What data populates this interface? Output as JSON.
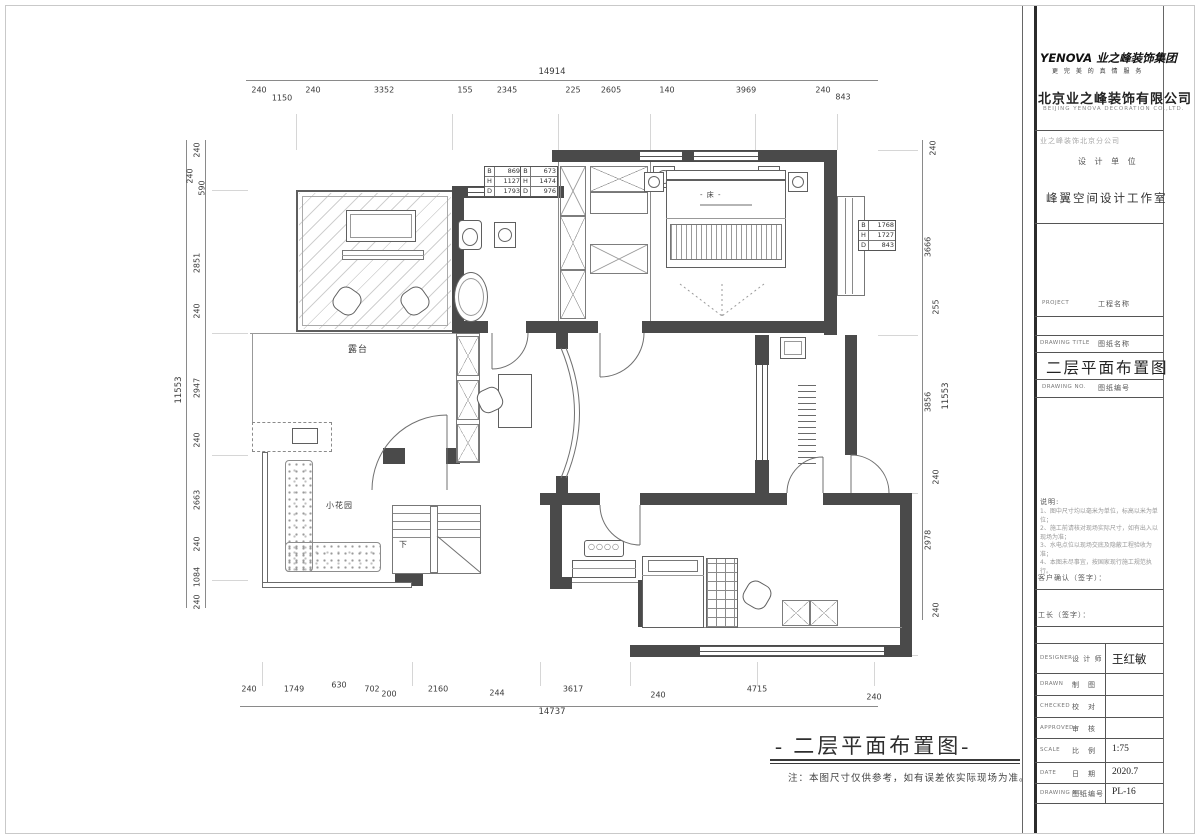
{
  "dims": {
    "top_total": "14914",
    "top": [
      "240",
      "1150",
      "240",
      "3352",
      "155",
      "2345",
      "225",
      "2605",
      "140",
      "3969",
      "240",
      "843"
    ],
    "bottom_total": "14737",
    "bottom": [
      "240",
      "1749",
      "630",
      "702",
      "200",
      "2160",
      "244",
      "3617",
      "240",
      "4715",
      "240"
    ],
    "left_total": "11553",
    "left": [
      "240",
      "240",
      "590",
      "2851",
      "240",
      "2947",
      "240",
      "2663",
      "240",
      "1084",
      "240"
    ],
    "right_total": "11553",
    "right": [
      "240",
      "3666",
      "255",
      "3856",
      "240",
      "2978",
      "240"
    ]
  },
  "plan": {
    "labels": {
      "terrace": "露台",
      "garden": "小花园",
      "bed": "- 床 -",
      "stairs_down": "下"
    },
    "bhd1": {
      "B": "869",
      "H": "1127",
      "D": "1793"
    },
    "bhd2": {
      "B": "673",
      "H": "1474",
      "D": "976"
    },
    "bhd3": {
      "B": "1768",
      "H": "1727",
      "D": "843"
    }
  },
  "caption": {
    "title": "- 二层平面布置图-",
    "note": "注：本图尺寸仅供参考，如有误差依实际现场为准。"
  },
  "titleblock": {
    "logo": "YENOVA 业之峰装饰集团",
    "logo_tagline": "更 完 美 的 真 情 服 务",
    "company": "北京业之峰装饰有限公司",
    "company_en": "BEIJING YENOVA DECORATION CO.,LTD.",
    "branch": "业之峰装饰北京分公司",
    "design_unit_label": "设 计 单 位",
    "studio": "峰翼空间设计工作室",
    "project_en": "PROJECT",
    "project_cn": "工程名称",
    "title_en": "DRAWING TITLE",
    "title_cn": "图纸名称",
    "drawing_title": "二层平面布置图",
    "subno_en": "DRAWING NO.",
    "subno_cn": "图纸编号",
    "notes_title": "说明:",
    "notes": [
      "1、图中尺寸均以毫米为单位，标高以米为单位；",
      "2、施工前请核对现场实际尺寸，如有出入以现场为准；",
      "3、水电点位以现场交底及隐蔽工程验收为准；",
      "4、本图未尽事宜，按国家现行施工规范执行。"
    ],
    "confirm_label": "客户确认（签字）：",
    "foreman_label": "工长（签字）：",
    "rows": [
      {
        "en": "DESIGNER",
        "cn": "设 计 师",
        "value": "王红敏"
      },
      {
        "en": "DRAWN",
        "cn": "制　图",
        "value": ""
      },
      {
        "en": "CHECKED",
        "cn": "校　对",
        "value": ""
      },
      {
        "en": "APPROVED",
        "cn": "审　核",
        "value": ""
      },
      {
        "en": "SCALE",
        "cn": "比　例",
        "value": "1:75"
      },
      {
        "en": "DATE",
        "cn": "日　期",
        "value": "2020.7"
      },
      {
        "en": "DRAWING NO",
        "cn": "图纸编号",
        "value": "PL-16"
      }
    ]
  }
}
